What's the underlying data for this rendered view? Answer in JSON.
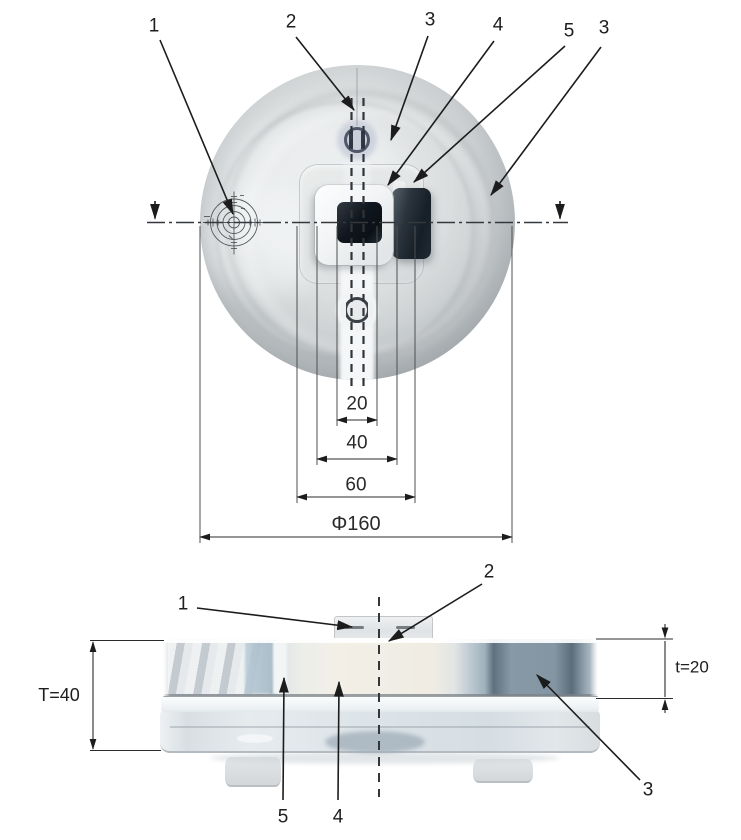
{
  "palette": {
    "line": "#222222",
    "background": "#ffffff"
  },
  "top_view": {
    "callouts": [
      {
        "id": "callout-1",
        "label": "1"
      },
      {
        "id": "callout-2",
        "label": "2"
      },
      {
        "id": "callout-3a",
        "label": "3"
      },
      {
        "id": "callout-4",
        "label": "4"
      },
      {
        "id": "callout-5",
        "label": "5"
      },
      {
        "id": "callout-3b",
        "label": "3"
      }
    ],
    "dimensions": [
      {
        "id": "dim-slot-width",
        "label": "20"
      },
      {
        "id": "dim-block-width",
        "label": "40"
      },
      {
        "id": "dim-plate-width",
        "label": "60"
      },
      {
        "id": "dim-outer-diameter",
        "label": "Φ160"
      }
    ]
  },
  "side_view": {
    "callouts": [
      {
        "id": "callout-1",
        "label": "1"
      },
      {
        "id": "callout-2",
        "label": "2"
      },
      {
        "id": "callout-5",
        "label": "5"
      },
      {
        "id": "callout-4",
        "label": "4"
      },
      {
        "id": "callout-3",
        "label": "3"
      }
    ],
    "dimensions": [
      {
        "id": "dim-total-thickness",
        "label": "T=40"
      },
      {
        "id": "dim-top-thickness",
        "label": "t=20"
      }
    ]
  }
}
